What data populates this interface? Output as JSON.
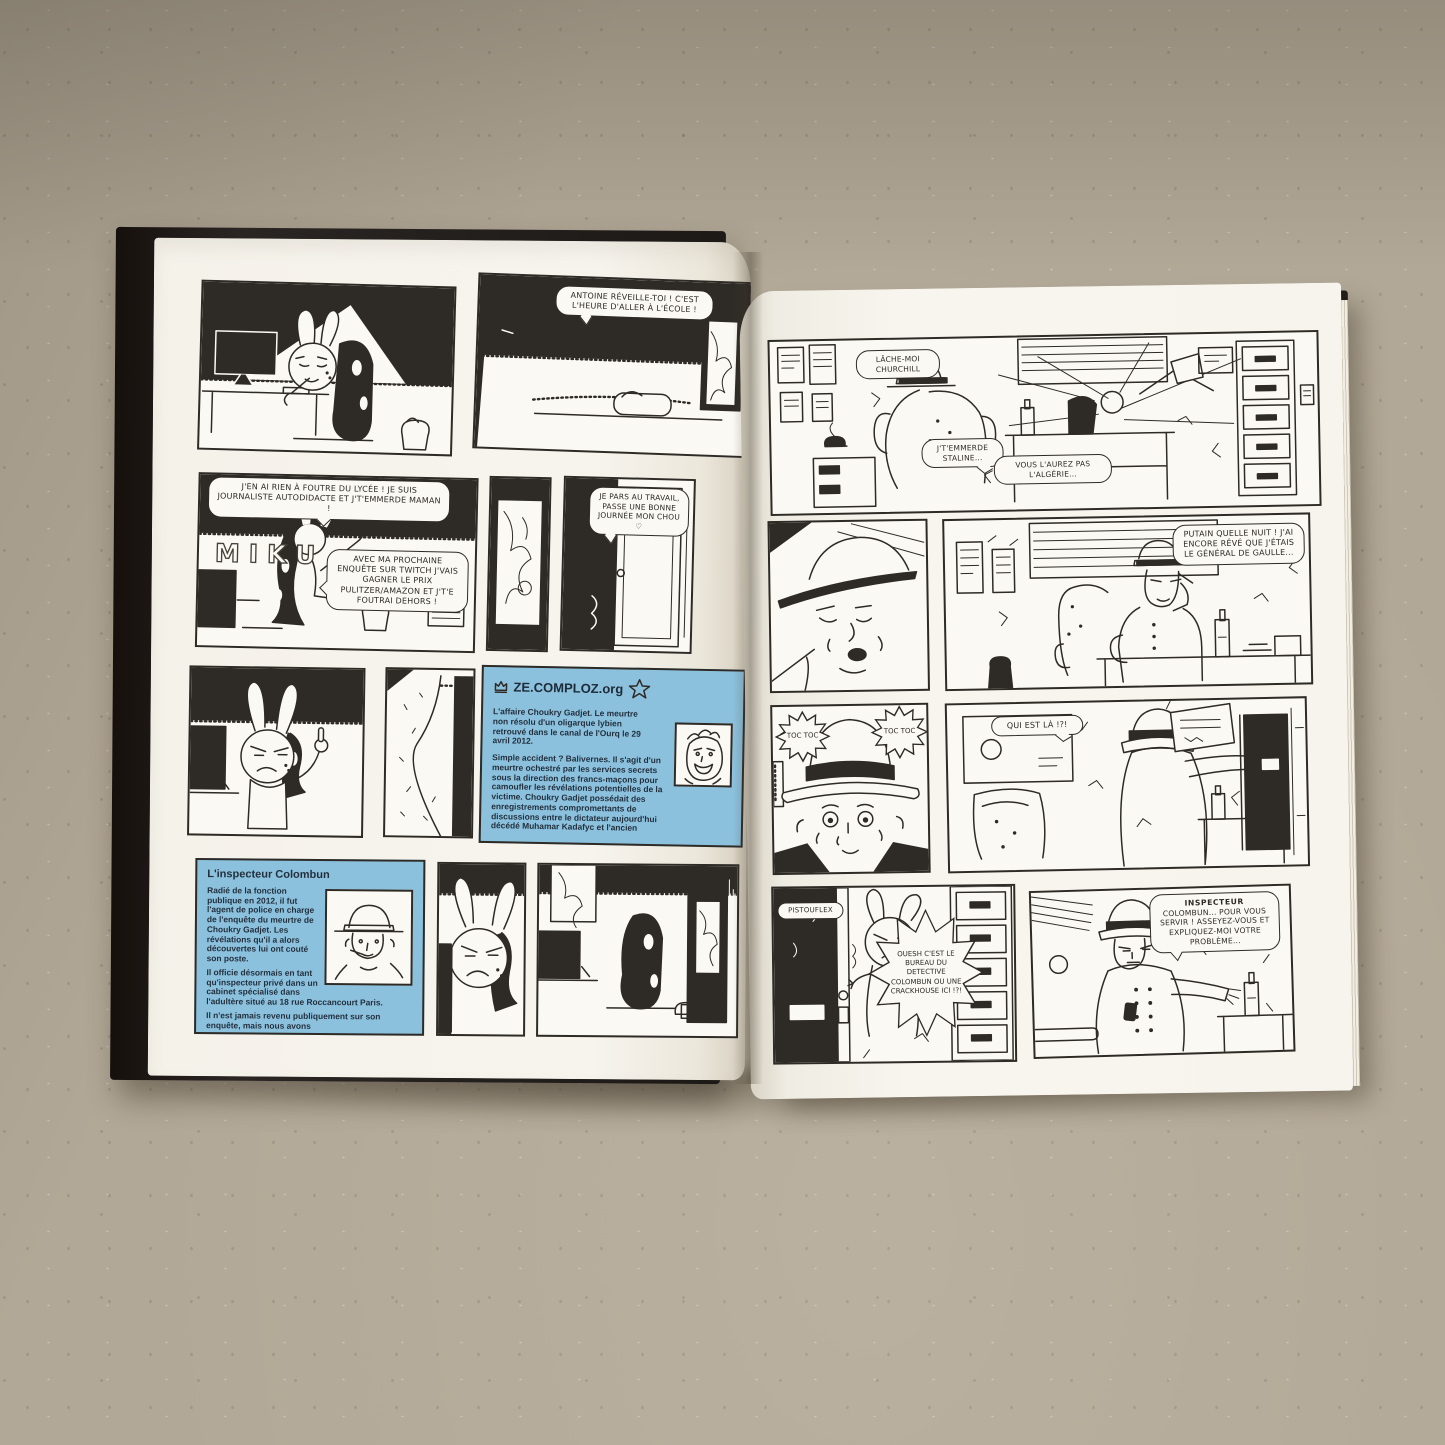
{
  "scene": {
    "background_color": "#b2a897",
    "page_color": "#f6f3ec",
    "ink_color": "#2e2b26",
    "blue_panel_color": "#8cc1de",
    "blue_text_color": "#22303d"
  },
  "left_page": {
    "wake_bubble": "ANTOINE RÉVEILLE-TOI ! C'EST L'HEURE D'ALLER À L'ÉCOLE !",
    "lycee_bubble": "J'EN AI RIEN À FOUTRE DU LYCÉE ! JE SUIS JOURNALISTE AUTODIDACTE ET J'T'EMMERDE MAMAN !",
    "twitch_bubble": "AVEC MA PROCHAINE ENQUÊTE SUR TWITCH J'VAIS GAGNER LE PRIX PULITZER/AMAZON ET J'T'E FOUTRAI DEHORS !",
    "wall_poster_text": "MIKU",
    "door_bubble": "JE PARS AU TRAVAIL, PASSE UNE BONNE JOURNÉE MON CHOU ♡",
    "comploz": {
      "site": "ZE.COMPLOZ.org",
      "para1": "L'affaire Choukry Gadjet. Le meurtre non résolu d'un oligarque lybien retrouvé dans le canal de l'Ourq le 29 avril 2012.",
      "para2": "Simple accident ? Balivernes. Il s'agit d'un meurtre ochestré par les services secrets sous la direction des francs-maçons pour camoufler les révélations potentielles de la victime. Choukry Gadjet possédait des enregistrements compromettants de discussions entre le dictateur aujourd'hui décédé Muhamar Kadafyc et l'ancien"
    },
    "inspector": {
      "title": "L'inspecteur Colombun",
      "para1": "Radié de la fonction publique en 2012, il fut l'agent de police en charge de l'enquête du meurtre de Choukry Gadjet. Les révélations qu'il a alors découvertes lui ont couté son poste.",
      "para2": "Il officie désormais en tant qu'inspecteur privé dans un cabinet spécialisé dans l'adultère situé au 18 rue Roccancourt Paris.",
      "para3": "Il n'est jamais revenu publiquement sur son enquête, mais nous avons"
    }
  },
  "right_page": {
    "r1": {
      "bubble_churchill": "LÂCHE-MOI CHURCHILL",
      "bubble_staline": "J'T'EMMERDE STALINE...",
      "bubble_algerie": "VOUS L'AUREZ PAS L'ALGÉRIE..."
    },
    "r2": {
      "bubble_degaulle": "PUTAIN QUELLE NUIT ! J'AI ENCORE RÊVÉ QUE J'ÉTAIS LE GÉNÉRAL DE GAULLE..."
    },
    "r3": {
      "toc_left": "TOC TOC",
      "toc_right": "TOC TOC",
      "bubble_quiestla": "QUI EST LÀ !?!"
    },
    "r4": {
      "door_sign": "PISTOUFLEX",
      "bubble_crackhouse": "OUESH C'EST LE BUREAU DU DETECTIVE COLOMBUN OU UNE CRACKHOUSE ICI !?!",
      "insp_title": "INSPECTEUR",
      "insp_rest": "COLOMBUN... POUR VOUS SERVIR ! ASSEYEZ-VOUS ET EXPLIQUEZ-MOI VOTRE PROBLÈME..."
    }
  }
}
